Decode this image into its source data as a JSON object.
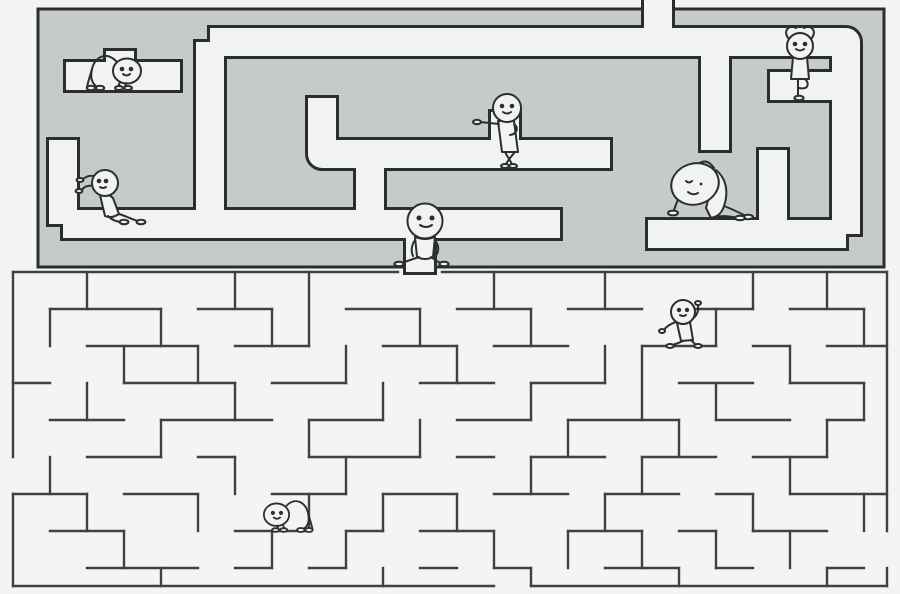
{
  "canvas": {
    "width": 900,
    "height": 594
  },
  "colors": {
    "page_bg": "#f4f5f2",
    "maze_top_fill": "#c5ccc7",
    "corridor": "#f1f3f0",
    "ink": "#2c2e2d",
    "wall": "#3f4240",
    "figure_fill": "#f1f3f0"
  },
  "top_maze": {
    "border": [
      38,
      9,
      846,
      258
    ],
    "corridor_width": 28,
    "outline_extra": 6,
    "corridors": [
      [
        658,
        -14,
        658,
        42
      ],
      [
        658,
        42,
        210,
        42
      ],
      [
        210,
        42,
        210,
        224
      ],
      [
        63,
        224,
        560,
        224
      ],
      [
        420,
        224,
        420,
        272
      ],
      [
        66,
        76,
        180,
        76
      ],
      [
        120,
        51,
        120,
        76
      ],
      [
        63,
        140,
        63,
        224
      ],
      [
        322,
        98,
        322,
        154,
        610,
        154
      ],
      [
        505,
        112,
        505,
        154
      ],
      [
        370,
        154,
        370,
        224
      ],
      [
        648,
        234,
        846,
        234
      ],
      [
        658,
        42,
        846,
        42,
        846,
        234
      ],
      [
        770,
        86,
        832,
        86
      ],
      [
        773,
        150,
        773,
        234
      ],
      [
        715,
        42,
        715,
        150
      ]
    ]
  },
  "bottom_maze": {
    "wall_width": 2.4,
    "walls": [
      [
        13,
        272,
        398,
        272
      ],
      [
        442,
        272,
        887,
        272
      ],
      [
        13,
        272,
        13,
        457
      ],
      [
        13,
        494,
        13,
        586
      ],
      [
        887,
        272,
        887,
        531
      ],
      [
        887,
        568,
        887,
        586
      ],
      [
        13,
        586,
        494,
        586
      ],
      [
        531,
        586,
        887,
        586
      ],
      [
        50,
        309,
        161,
        309
      ],
      [
        198,
        309,
        272,
        309
      ],
      [
        346,
        309,
        420,
        309
      ],
      [
        457,
        309,
        531,
        309
      ],
      [
        568,
        309,
        642,
        309
      ],
      [
        679,
        309,
        753,
        309
      ],
      [
        790,
        309,
        864,
        309
      ],
      [
        87,
        346,
        198,
        346
      ],
      [
        235,
        346,
        309,
        346
      ],
      [
        383,
        346,
        457,
        346
      ],
      [
        494,
        346,
        568,
        346
      ],
      [
        642,
        346,
        716,
        346
      ],
      [
        753,
        346,
        790,
        346
      ],
      [
        827,
        346,
        887,
        346
      ],
      [
        13,
        383,
        50,
        383
      ],
      [
        124,
        383,
        235,
        383
      ],
      [
        272,
        383,
        346,
        383
      ],
      [
        420,
        383,
        494,
        383
      ],
      [
        531,
        383,
        605,
        383
      ],
      [
        679,
        383,
        753,
        383
      ],
      [
        790,
        383,
        864,
        383
      ],
      [
        50,
        420,
        124,
        420
      ],
      [
        161,
        420,
        272,
        420
      ],
      [
        309,
        420,
        383,
        420
      ],
      [
        457,
        420,
        531,
        420
      ],
      [
        568,
        420,
        679,
        420
      ],
      [
        716,
        420,
        790,
        420
      ],
      [
        827,
        420,
        864,
        420
      ],
      [
        87,
        457,
        161,
        457
      ],
      [
        198,
        457,
        235,
        457
      ],
      [
        309,
        457,
        420,
        457
      ],
      [
        457,
        457,
        494,
        457
      ],
      [
        531,
        457,
        605,
        457
      ],
      [
        642,
        457,
        716,
        457
      ],
      [
        753,
        457,
        827,
        457
      ],
      [
        13,
        494,
        87,
        494
      ],
      [
        124,
        494,
        198,
        494
      ],
      [
        272,
        494,
        346,
        494
      ],
      [
        383,
        494,
        457,
        494
      ],
      [
        494,
        494,
        568,
        494
      ],
      [
        605,
        494,
        679,
        494
      ],
      [
        716,
        494,
        753,
        494
      ],
      [
        790,
        494,
        887,
        494
      ],
      [
        50,
        531,
        124,
        531
      ],
      [
        235,
        531,
        309,
        531
      ],
      [
        346,
        531,
        383,
        531
      ],
      [
        420,
        531,
        494,
        531
      ],
      [
        568,
        531,
        642,
        531
      ],
      [
        679,
        531,
        716,
        531
      ],
      [
        753,
        531,
        827,
        531
      ],
      [
        87,
        568,
        198,
        568
      ],
      [
        235,
        568,
        272,
        568
      ],
      [
        309,
        568,
        346,
        568
      ],
      [
        420,
        568,
        457,
        568
      ],
      [
        494,
        568,
        531,
        568
      ],
      [
        605,
        568,
        679,
        568
      ],
      [
        716,
        568,
        753,
        568
      ],
      [
        827,
        568,
        864,
        568
      ],
      [
        87,
        272,
        87,
        309
      ],
      [
        235,
        272,
        235,
        309
      ],
      [
        309,
        272,
        309,
        346
      ],
      [
        494,
        272,
        494,
        309
      ],
      [
        605,
        272,
        605,
        309
      ],
      [
        753,
        272,
        753,
        309
      ],
      [
        827,
        272,
        827,
        309
      ],
      [
        50,
        309,
        50,
        346
      ],
      [
        161,
        309,
        161,
        346
      ],
      [
        272,
        309,
        272,
        346
      ],
      [
        420,
        309,
        420,
        346
      ],
      [
        531,
        309,
        531,
        346
      ],
      [
        716,
        309,
        716,
        346
      ],
      [
        864,
        309,
        864,
        346
      ],
      [
        124,
        346,
        124,
        383
      ],
      [
        198,
        346,
        198,
        383
      ],
      [
        346,
        346,
        346,
        383
      ],
      [
        457,
        346,
        457,
        383
      ],
      [
        605,
        346,
        605,
        383
      ],
      [
        642,
        346,
        642,
        420
      ],
      [
        790,
        346,
        790,
        383
      ],
      [
        87,
        383,
        87,
        420
      ],
      [
        235,
        383,
        235,
        420
      ],
      [
        383,
        383,
        383,
        420
      ],
      [
        531,
        383,
        531,
        420
      ],
      [
        716,
        383,
        716,
        420
      ],
      [
        864,
        383,
        864,
        420
      ],
      [
        161,
        420,
        161,
        457
      ],
      [
        309,
        420,
        309,
        457
      ],
      [
        420,
        420,
        420,
        457
      ],
      [
        568,
        420,
        568,
        457
      ],
      [
        679,
        420,
        679,
        457
      ],
      [
        827,
        420,
        827,
        457
      ],
      [
        50,
        457,
        50,
        494
      ],
      [
        235,
        457,
        235,
        494
      ],
      [
        346,
        457,
        346,
        494
      ],
      [
        531,
        457,
        531,
        494
      ],
      [
        642,
        457,
        642,
        494
      ],
      [
        790,
        457,
        790,
        494
      ],
      [
        87,
        494,
        87,
        531
      ],
      [
        198,
        494,
        198,
        531
      ],
      [
        309,
        494,
        309,
        531
      ],
      [
        383,
        494,
        383,
        531
      ],
      [
        457,
        494,
        457,
        531
      ],
      [
        605,
        494,
        605,
        531
      ],
      [
        753,
        494,
        753,
        531
      ],
      [
        864,
        494,
        864,
        531
      ],
      [
        124,
        531,
        124,
        568
      ],
      [
        272,
        531,
        272,
        568
      ],
      [
        346,
        531,
        346,
        568
      ],
      [
        494,
        531,
        494,
        568
      ],
      [
        568,
        531,
        568,
        568
      ],
      [
        642,
        531,
        642,
        568
      ],
      [
        716,
        531,
        716,
        568
      ],
      [
        790,
        531,
        790,
        568
      ],
      [
        161,
        568,
        161,
        586
      ],
      [
        383,
        568,
        383,
        586
      ],
      [
        531,
        568,
        531,
        586
      ],
      [
        679,
        568,
        679,
        586
      ],
      [
        827,
        568,
        827,
        586
      ]
    ]
  },
  "characters": [
    {
      "name": "crawling-figure-top-left",
      "pose": "crawl",
      "transform": "translate(112,88)"
    },
    {
      "name": "wall-push-figure-left",
      "pose": "push",
      "transform": "translate(105,222)"
    },
    {
      "name": "pointing-figure-top",
      "pose": "point",
      "transform": "translate(505,166)"
    },
    {
      "name": "walking-figure-center",
      "pose": "walk",
      "transform": "translate(423,262)"
    },
    {
      "name": "side-stretch-figure-right",
      "pose": "stretch",
      "transform": "translate(702,218)"
    },
    {
      "name": "yoga-figure-top-right",
      "pose": "yoga",
      "transform": "translate(800,98)"
    },
    {
      "name": "waving-figure-bottom-maze",
      "pose": "wave",
      "transform": "translate(683,344)"
    },
    {
      "name": "crawling-figure-bottom",
      "pose": "crawl",
      "transform": "translate(290,530) scale(-0.9,0.9)"
    }
  ]
}
